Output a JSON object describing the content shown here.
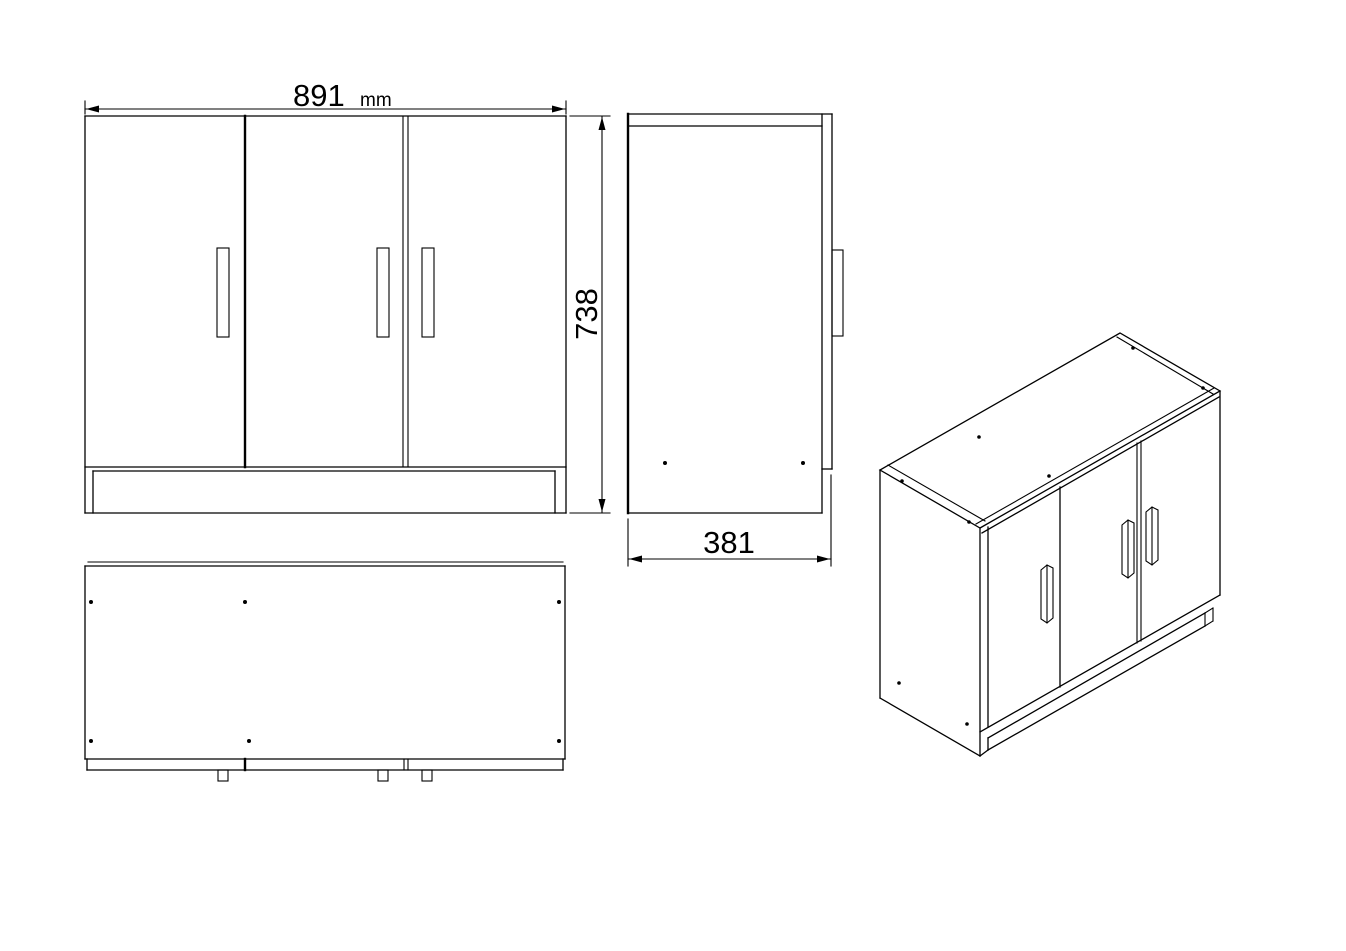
{
  "drawing": {
    "type": "furniture-orthographic-drawing",
    "subject": "three-door cabinet / sideboard",
    "dimensions": {
      "width": {
        "value": "891",
        "unit": "mm"
      },
      "height": {
        "value": "738"
      },
      "depth": {
        "value": "381"
      }
    },
    "views": {
      "front": "front view with three doors and plinth",
      "side": "side view with door handle",
      "bottom": "bottom view with three door handles",
      "isometric": "isometric view of assembled cabinet"
    },
    "colors": {
      "line": "#000000",
      "background": "#ffffff"
    }
  }
}
